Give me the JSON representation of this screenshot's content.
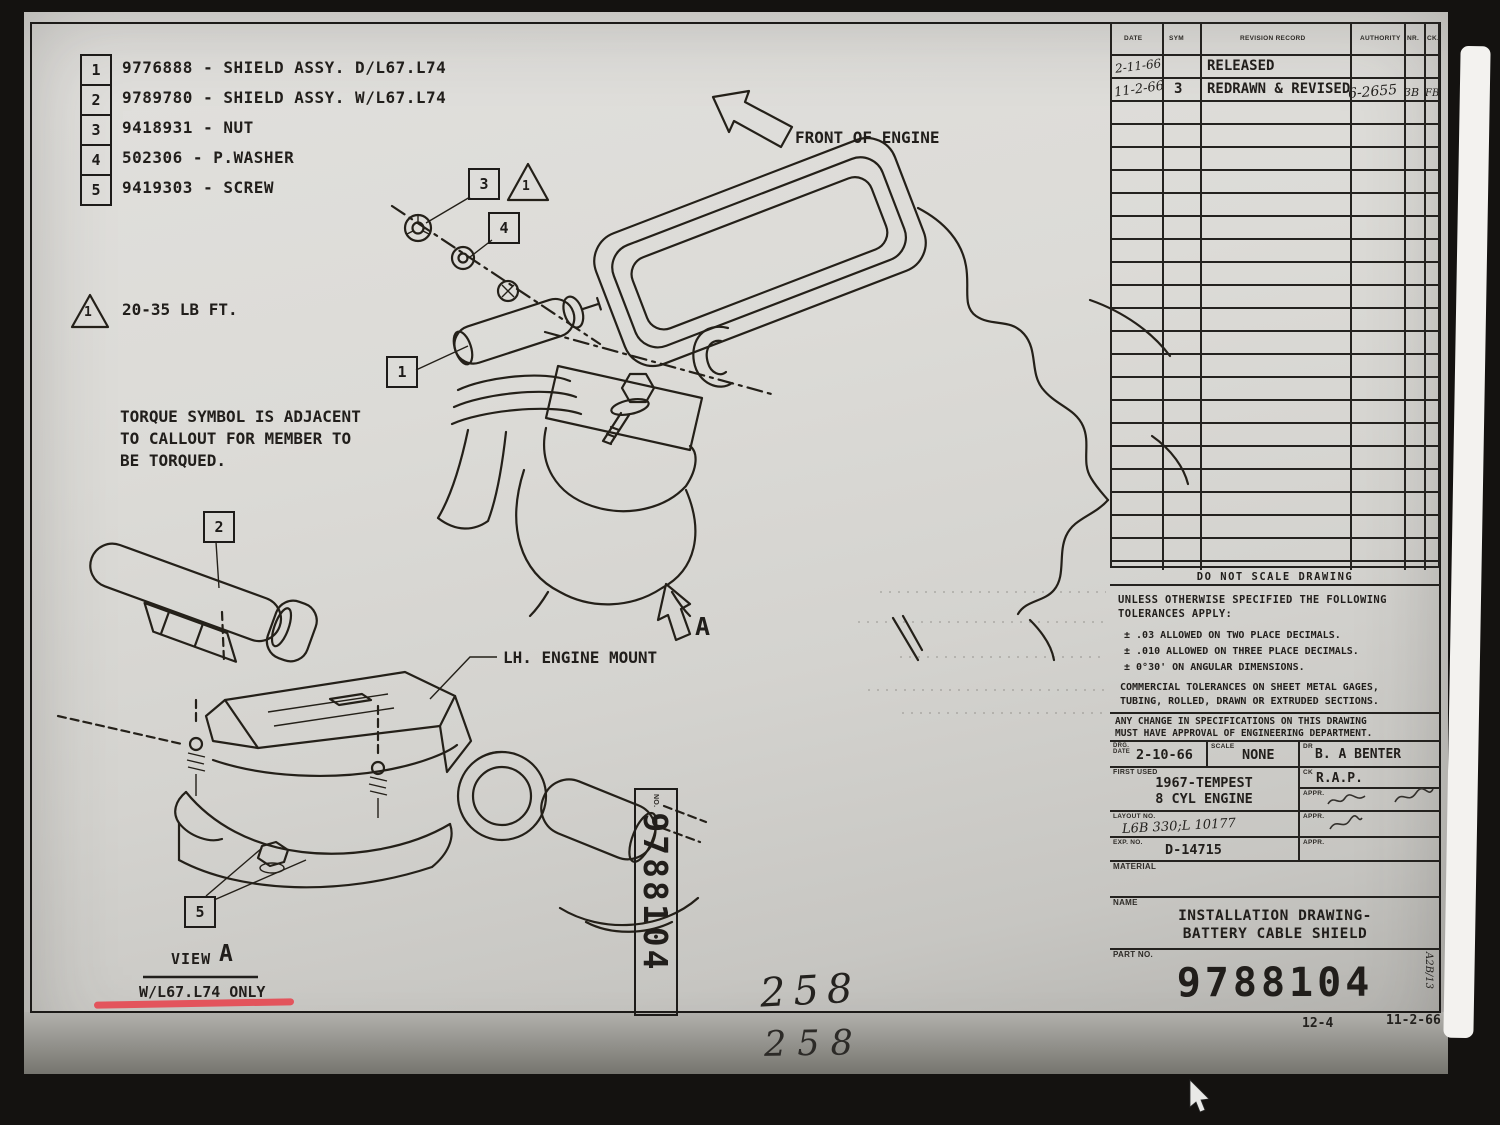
{
  "sheet": {
    "parts": [
      {
        "num": "1",
        "text": "9776888 - SHIELD ASSY. D/L67.L74"
      },
      {
        "num": "2",
        "text": "9789780 - SHIELD ASSY. W/L67.L74"
      },
      {
        "num": "3",
        "text": "9418931 - NUT"
      },
      {
        "num": "4",
        "text": "502306 - P.WASHER"
      },
      {
        "num": "5",
        "text": "9419303 - SCREW"
      }
    ],
    "torque_symbol_num": "1",
    "torque_value": "20-35 LB FT.",
    "torque_note": "TORQUE SYMBOL IS ADJACENT\nTO CALLOUT FOR MEMBER TO\nBE TORQUED.",
    "front_of_engine": "FRONT OF ENGINE",
    "lh_engine_mount": "LH. ENGINE MOUNT",
    "section_arrow_letter": "A",
    "view_word": "VIEW",
    "view_letter": "A",
    "view_condition": "W/L67.L74 ONLY",
    "callouts": {
      "c1": "1",
      "c2": "2",
      "c3": "3",
      "c4": "4",
      "c5": "5",
      "triangle_num": "1"
    },
    "stamp": {
      "no_label": "NO.",
      "number": "9788104"
    },
    "handwritten": {
      "sheet_number_top": "258",
      "sheet_number_bottom": "258"
    }
  },
  "title_block": {
    "revision": {
      "headers": {
        "date": "DATE",
        "sym": "SYM",
        "record": "REVISION RECORD",
        "authority": "AUTHORITY",
        "nr": "NR.",
        "ck": "CK."
      },
      "row1": {
        "date": "2-11-66",
        "record": "RELEASED"
      },
      "row2": {
        "date": "11-2-66",
        "sym": "3",
        "record": "REDRAWN & REVISED",
        "authority": "6-2655",
        "nr": "3B",
        "ck": "FB"
      }
    },
    "do_not_scale": "DO NOT SCALE DRAWING",
    "tol_intro": "UNLESS OTHERWISE SPECIFIED THE FOLLOWING\nTOLERANCES APPLY:",
    "tol_items": [
      "± .03 ALLOWED ON TWO PLACE DECIMALS.",
      "± .010 ALLOWED ON THREE PLACE DECIMALS.",
      "± 0°30' ON ANGULAR DIMENSIONS."
    ],
    "tol_commercial": "COMMERCIAL TOLERANCES ON SHEET METAL GAGES,\nTUBING, ROLLED, DRAWN OR EXTRUDED SECTIONS.",
    "change_note": "ANY CHANGE IN SPECIFICATIONS ON THIS DRAWING\nMUST HAVE APPROVAL OF ENGINEERING DEPARTMENT.",
    "drg_date_label": "DRG.\nDATE",
    "drg_date": "2-10-66",
    "scale_label": "SCALE",
    "scale_value": "NONE",
    "dr_label": "DR",
    "dr_value": "B. A BENTER",
    "first_used_label": "FIRST USED",
    "first_used_value": "1967-TEMPEST\n8 CYL ENGINE",
    "ck_label": "CK",
    "ck_value": "R.A.P.",
    "appr_label": "APPR.",
    "layout_label": "LAYOUT NO.",
    "layout_value": "L6B 330;L 10177",
    "exp_label": "EXP. NO.",
    "exp_value": "D-14715",
    "material_label": "MATERIAL",
    "name_label": "NAME",
    "name_value": "INSTALLATION DRAWING-\nBATTERY CABLE SHIELD",
    "part_no_label": "PART NO.",
    "part_no": "9788104",
    "side_mark": "A2B/13"
  },
  "footer": {
    "sheet_ref": "12-4",
    "date": "11-2-66"
  }
}
